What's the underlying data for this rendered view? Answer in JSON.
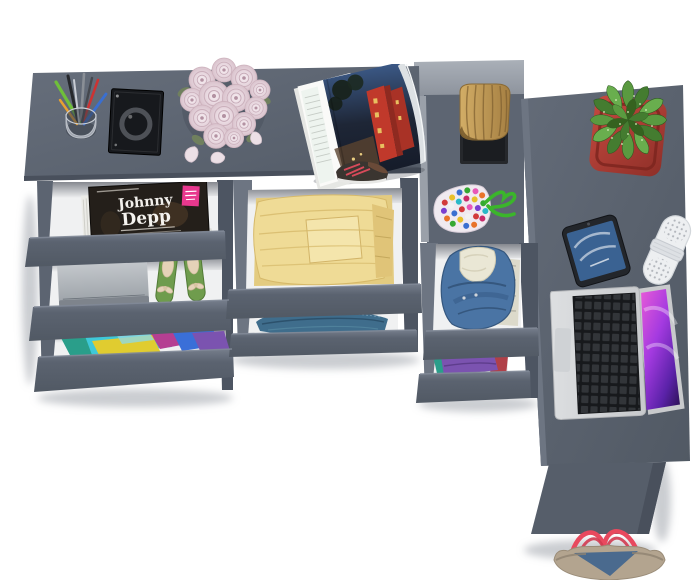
{
  "scene": {
    "type": "product-render",
    "subject": "Top-down 3D render of a dark gray corner desk / dresser with open drawers showing clothes and accessories",
    "background": "white floor"
  },
  "magazine": {
    "title_line1": "Johnny",
    "title_line2": "Depp"
  },
  "items": [
    "pen-cup",
    "black-portfolio",
    "rose-bouquet",
    "rose-petals",
    "open-magazine",
    "sneaker",
    "wooden-log",
    "black-tray",
    "candy-pouch",
    "potted-plant",
    "smartphone",
    "bluetooth-speaker",
    "open-laptop",
    "tote-bag",
    "magazine-johnny-depp",
    "magazine-with-circles",
    "closed-laptop",
    "green-ballet-flats",
    "colorful-clothes",
    "folded-yellow-clothes",
    "folded-jeans",
    "denim-jacket",
    "purple-teal-clothes"
  ],
  "colors": {
    "bg": "#ffffff",
    "desk": "#5c6471",
    "deskLight": "#6a7280",
    "deskEdge": "#49505c",
    "front": "#5d6572",
    "frontLight": "#7a8290",
    "wallDark": "#4d5562",
    "wallLight": "#6d7582",
    "step": "#9aa0a9",
    "interior": "#f0f1f2",
    "pedestal": "#565e6a",
    "badgePink": "#e8388e",
    "wood": "#c3a05e",
    "tray": "#26282c",
    "cordGreen": "#3bb52b",
    "potRed": "#b23a30",
    "leafGreen": "#55943c",
    "phoneBody": "#23262b",
    "phoneScreen": "#3a6292",
    "speakerWhite": "#edeff1",
    "silver": "#d6d8da",
    "keyDark": "#212428",
    "screenMagenta": "#c44ad0",
    "bagTaupe": "#b3a48f",
    "bagDenim": "#4a6a8e",
    "strapRed": "#e8495e",
    "roseBase": "#e9dae1",
    "yellowCloth": "#efdb96",
    "jeansBlue": "#3f6d8c",
    "denimBlue": "#4a74a4",
    "lining": "#eae7d5",
    "purpleCloth": "#7b53b0",
    "tealCloth": "#2a9e8a",
    "redCloth": "#b04048",
    "cyanCloth": "#3fc8d8",
    "magentaCloth": "#b53f92",
    "blueCloth": "#3a6fd8",
    "yellowCloth2": "#e0cc30",
    "flatGreen": "#6f9c4d",
    "bowBeige": "#e5d2b8"
  }
}
